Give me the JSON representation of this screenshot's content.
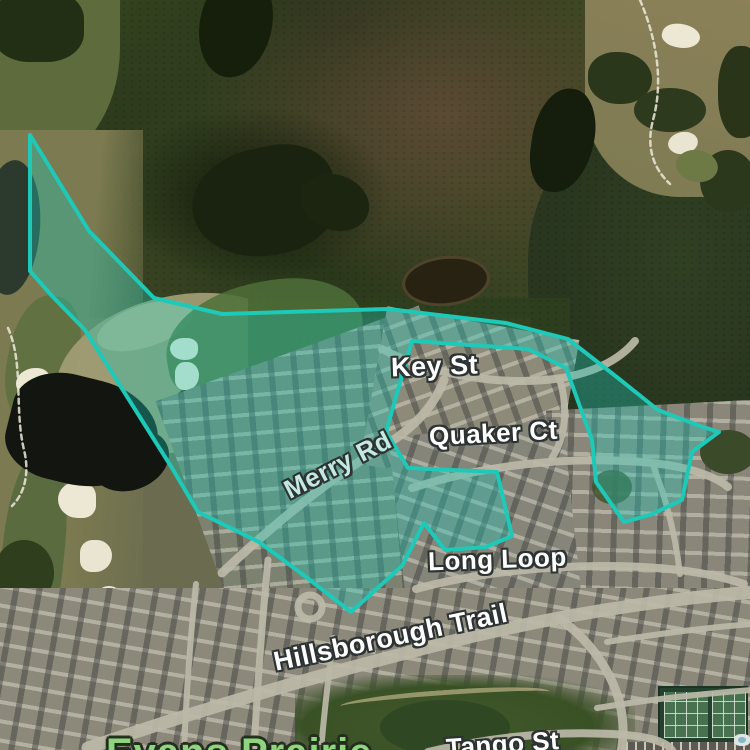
{
  "map": {
    "view": "satellite",
    "street_labels": {
      "key_st": "Key St",
      "quaker_ct": "Quaker Ct",
      "merry_rd": "Merry Rd",
      "long_loop": "Long Loop",
      "hillsborough_trail": "Hillsborough Trail",
      "tango_st": "Tango St"
    },
    "area_labels": {
      "evans_prairie": "Evans Prairie"
    },
    "label_colors": {
      "street": "#ffffff",
      "street_tinted": "#c4e9e1",
      "community": "#8fd47e",
      "halo": "#2c3131"
    }
  },
  "overlay": {
    "kind": "region-highlight",
    "stroke_color": "#1ec9b8",
    "fill_color": "rgba(30,200,184,0.36)",
    "points": [
      [
        30,
        135
      ],
      [
        89,
        231
      ],
      [
        154,
        298
      ],
      [
        222,
        314
      ],
      [
        388,
        309
      ],
      [
        506,
        323
      ],
      [
        568,
        339
      ],
      [
        618,
        378
      ],
      [
        658,
        410
      ],
      [
        700,
        426
      ],
      [
        719,
        432
      ],
      [
        692,
        452
      ],
      [
        682,
        500
      ],
      [
        650,
        515
      ],
      [
        624,
        522
      ],
      [
        596,
        482
      ],
      [
        592,
        440
      ],
      [
        566,
        368
      ],
      [
        528,
        349
      ],
      [
        412,
        341
      ],
      [
        386,
        432
      ],
      [
        408,
        468
      ],
      [
        497,
        472
      ],
      [
        512,
        536
      ],
      [
        486,
        547
      ],
      [
        445,
        550
      ],
      [
        424,
        523
      ],
      [
        402,
        566
      ],
      [
        351,
        612
      ],
      [
        306,
        577
      ],
      [
        259,
        542
      ],
      [
        198,
        512
      ],
      [
        172,
        468
      ],
      [
        85,
        330
      ],
      [
        52,
        296
      ],
      [
        30,
        271
      ]
    ]
  }
}
